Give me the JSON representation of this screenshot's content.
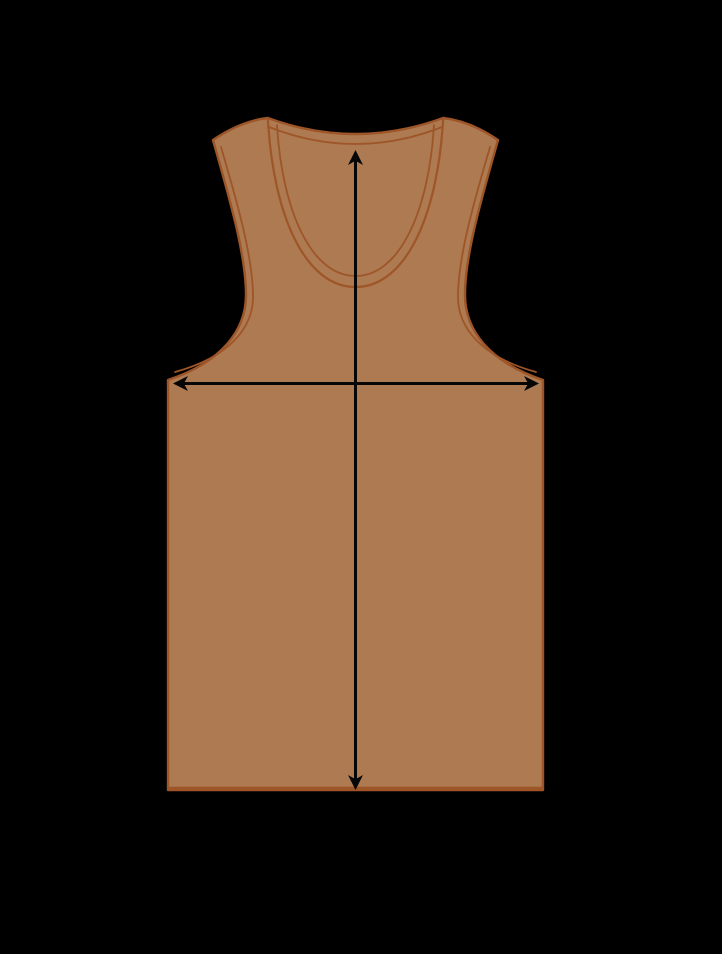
{
  "canvas": {
    "width": 722,
    "height": 954,
    "background_color": "#000000"
  },
  "garment": {
    "name": "tank-top",
    "fill_color": "#ad7a52",
    "outline_color": "#9e5528"
  },
  "measurements": {
    "arrow_color": "#060606",
    "length_arrow": {
      "orientation": "vertical",
      "double_headed": true
    },
    "width_arrow": {
      "orientation": "horizontal",
      "double_headed": true
    }
  }
}
